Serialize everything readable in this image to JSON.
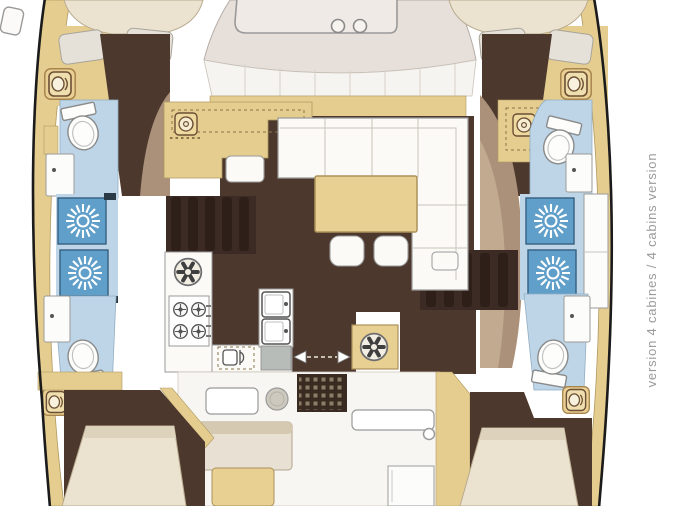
{
  "caption": {
    "text": "version 4 cabines / 4 cabins version"
  },
  "colors": {
    "hull_outline": "#1b1b1b",
    "deck_wood": "#e5cd8f",
    "cabin_floor_dark": "#4d382e",
    "stair_stripe": "#2e2019",
    "molding_taupe": "#ab9179",
    "bath_floor_blue": "#bdd5e7",
    "shower_pan_blue": "#5f9fc9",
    "bed_cream": "#ebe2d0",
    "roof_gray": "#e7e0da",
    "furniture_white": "#fbfaf7",
    "caption_gray": "#9b9b9b"
  },
  "icons": {
    "shower_drain_icon": "sunburst",
    "deck_hatch_icon": "hatch-with-porthole-and-latch",
    "stove_burner_icon": "circle-with-cross",
    "vent_fan_icon": "six-spoke-fan",
    "oven_icon": "dashed-oven-door",
    "nav_dial_icon": "dial-in-square",
    "sliding_door_icon": "double-headed-dashed-arrow",
    "toilet_icon": "toilet-bowl-with-tank",
    "sink_icon": "basin-with-faucet-dot"
  }
}
